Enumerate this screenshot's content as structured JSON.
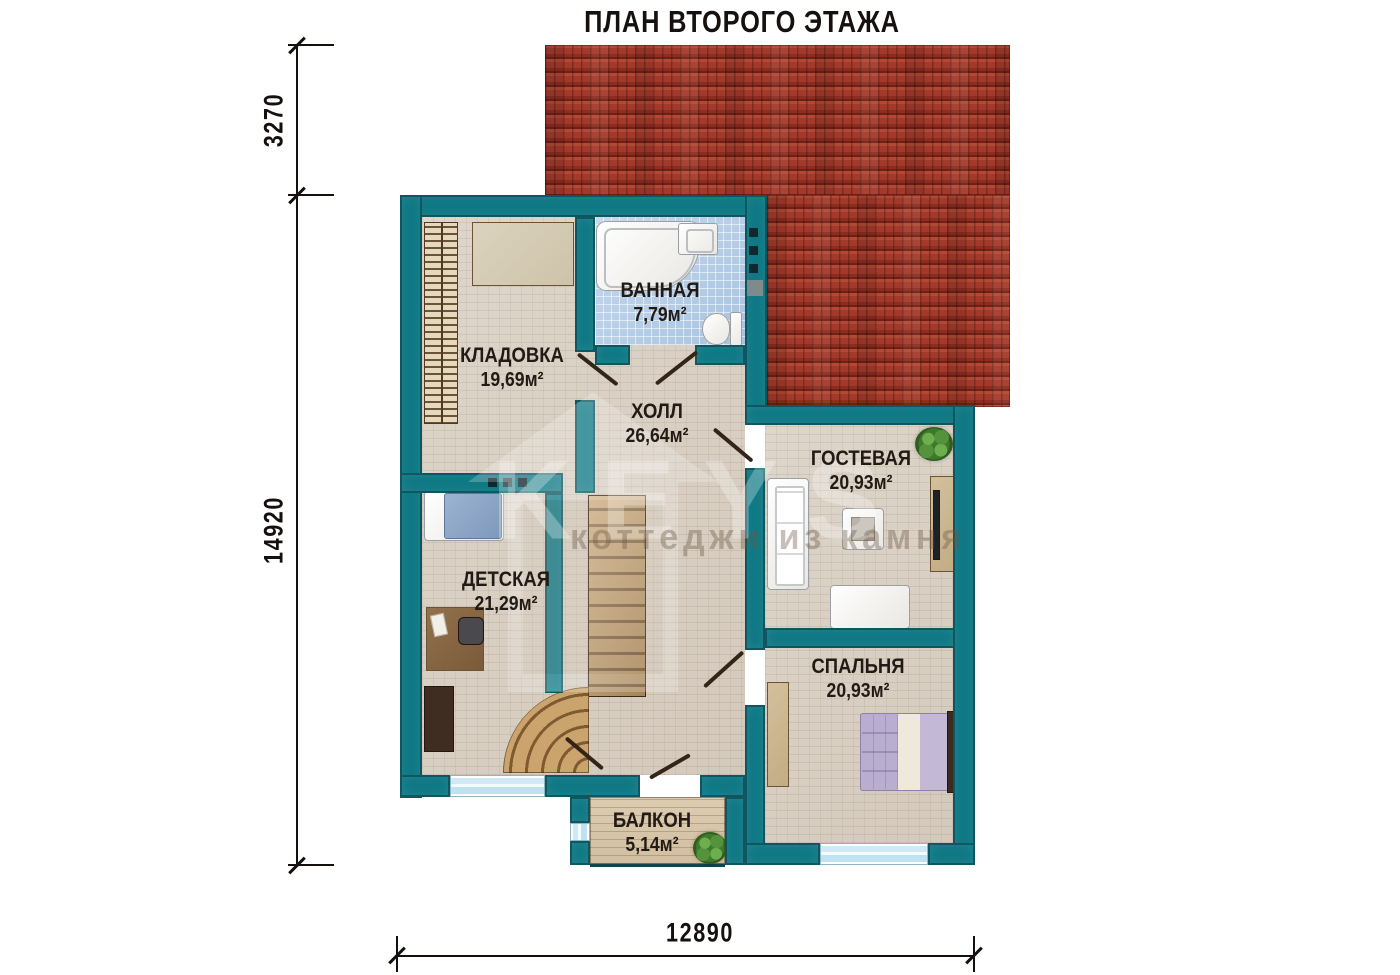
{
  "title": "ПЛАН ВТОРОГО ЭТАЖА",
  "dimensions": {
    "height_top": "3270",
    "height_total": "14920",
    "width_total": "12890"
  },
  "rooms": {
    "kladovka": {
      "name": "КЛАДОВКА",
      "area": "19,69м²"
    },
    "vannaya": {
      "name": "ВАННАЯ",
      "area": "7,79м²"
    },
    "holl": {
      "name": "ХОЛЛ",
      "area": "26,64м²"
    },
    "gostevaya": {
      "name": "ГОСТЕВАЯ",
      "area": "20,93м²"
    },
    "detskaya": {
      "name": "ДЕТСКАЯ",
      "area": "21,29м²"
    },
    "spalnya": {
      "name": "СПАЛЬНЯ",
      "area": "20,93м²"
    },
    "balkon": {
      "name": "БАЛКОН",
      "area": "5,14м²"
    }
  },
  "watermark": {
    "line1": "KEYS",
    "line2": "коттеджи из камня"
  },
  "colors": {
    "wall": "#0e7884",
    "wall-dark": "#083c44",
    "roof": "#a23a2b",
    "floor": "#d9d0c5",
    "tile": "#b7cee6",
    "wood": "#c19a63",
    "window": "#cdeaf7",
    "plant": "#4e8f3a",
    "ink": "#221a15"
  }
}
